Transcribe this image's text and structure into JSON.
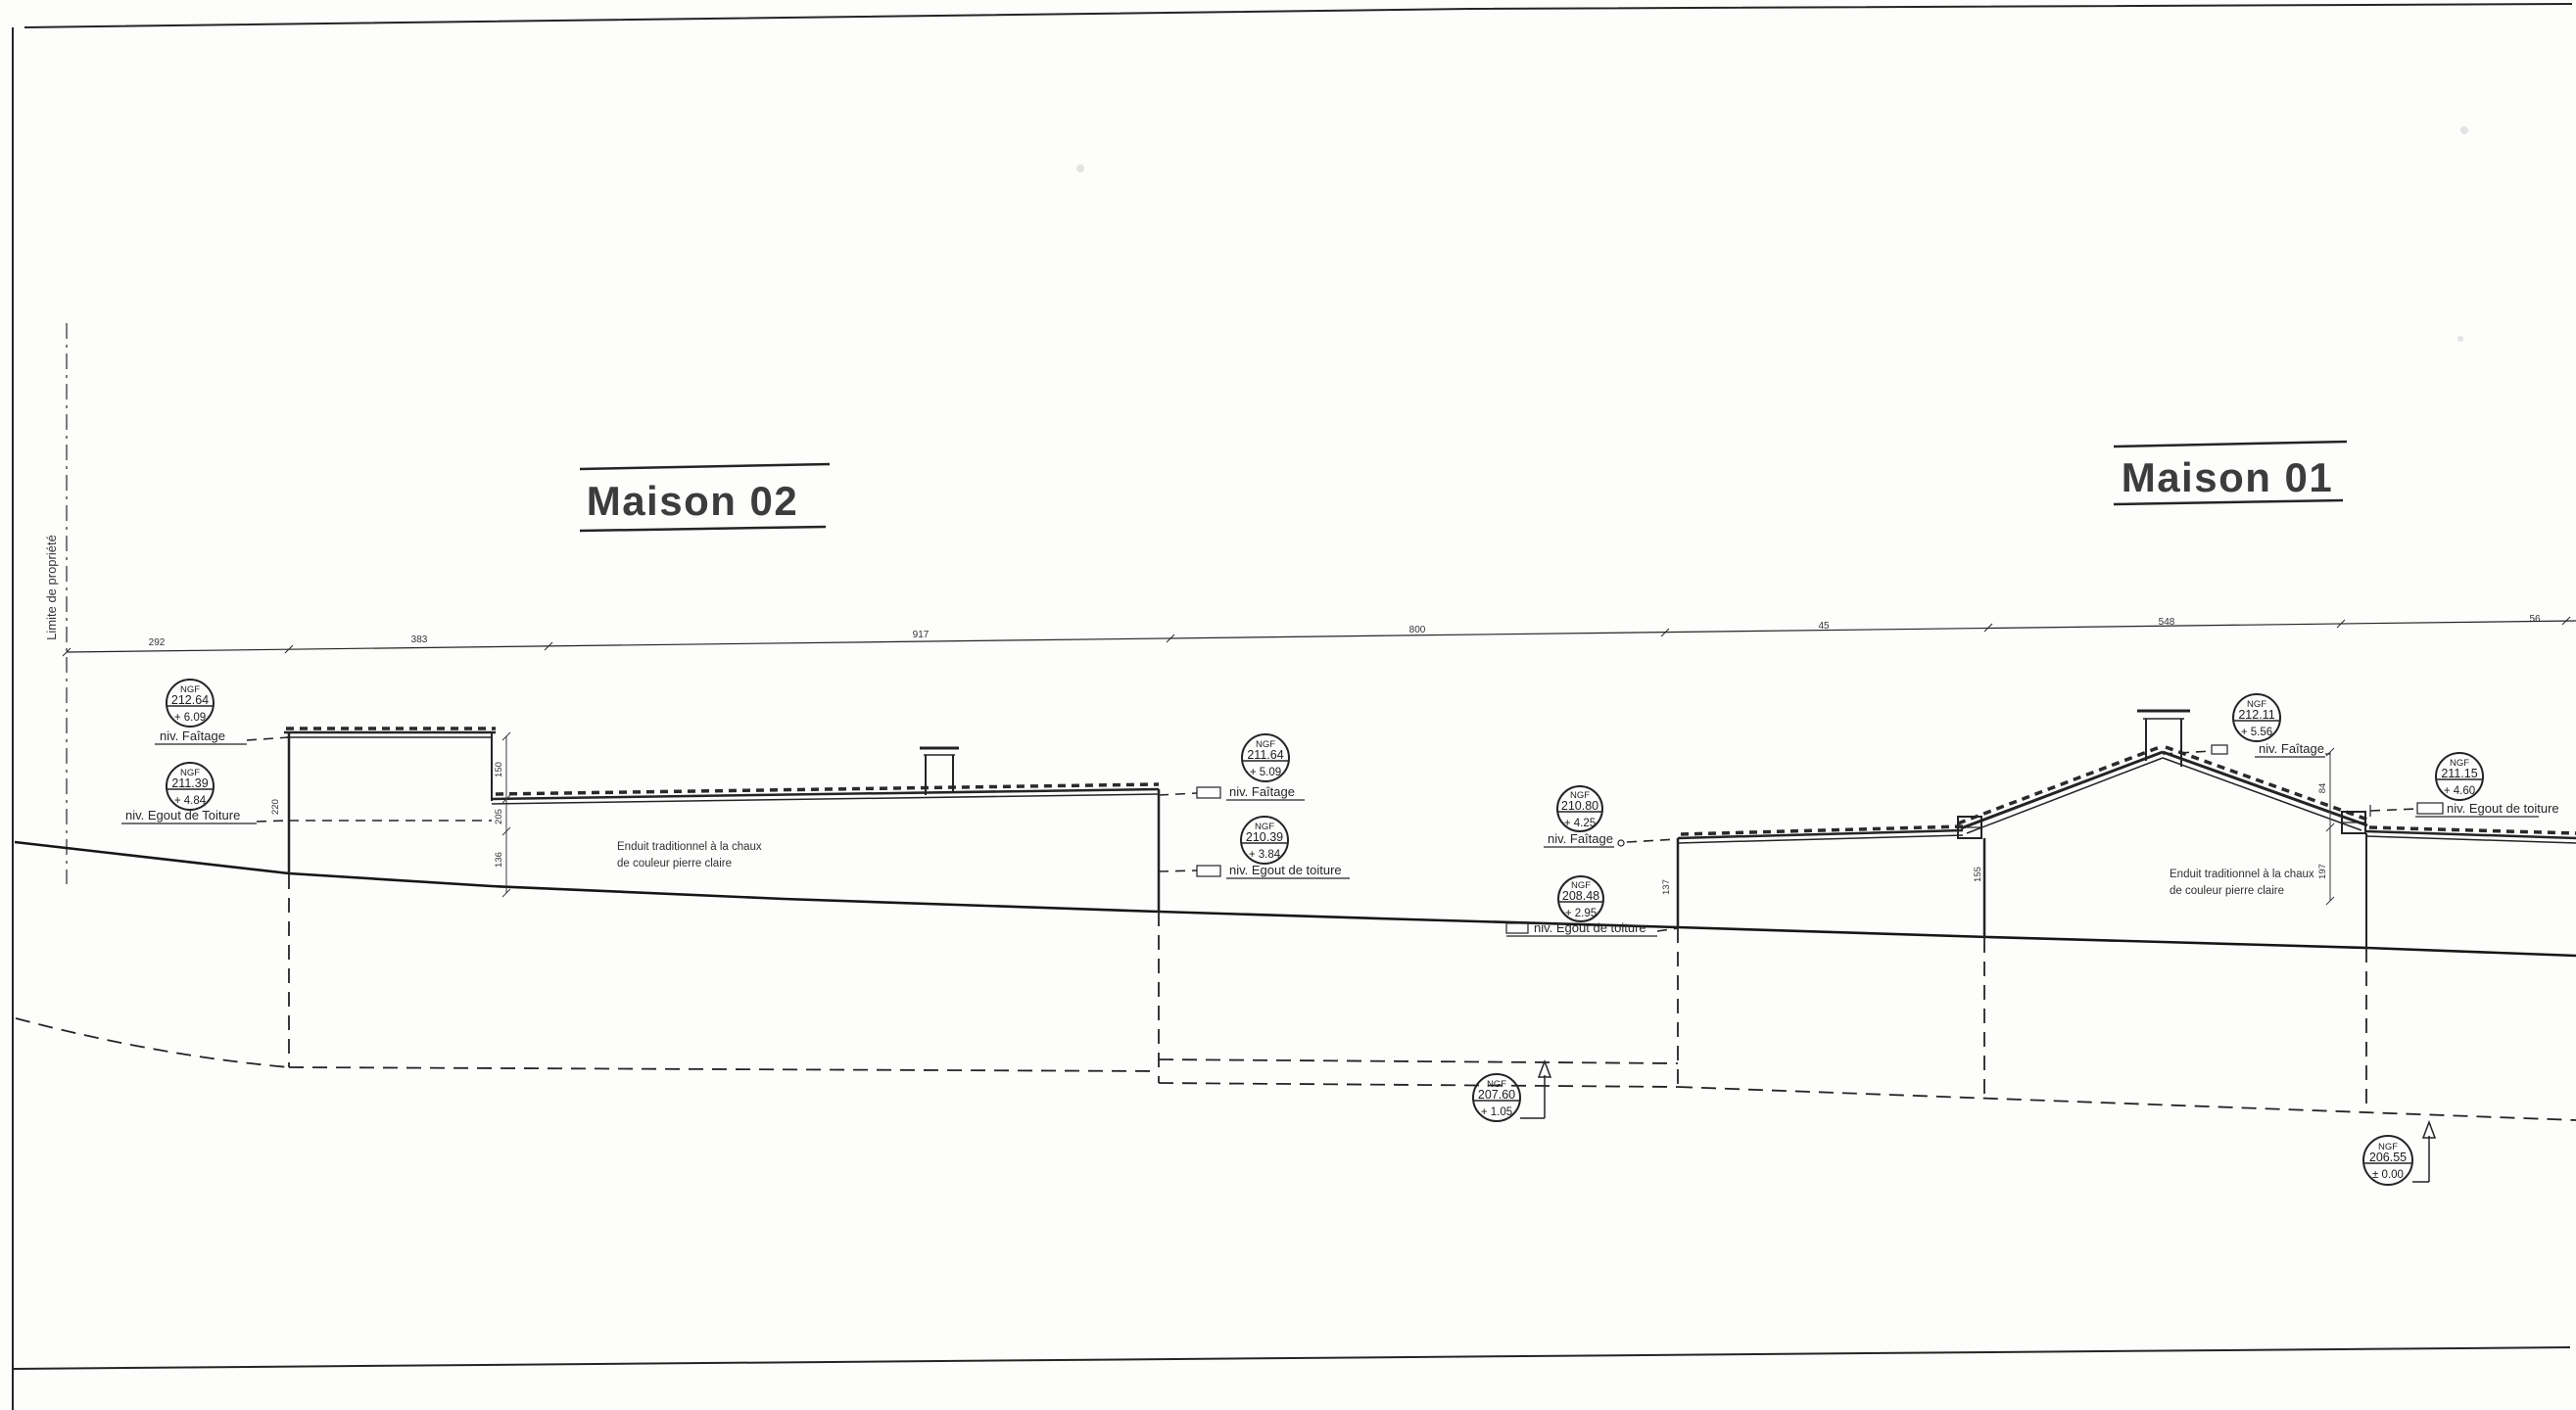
{
  "titles": {
    "maison02": "Maison 02",
    "maison01": "Maison 01"
  },
  "property_line": {
    "label": "Limite de propriété"
  },
  "top_dimensions": [
    "292",
    "383",
    "917",
    "800",
    "45",
    "548",
    "56"
  ],
  "vertical_dimensions": {
    "m02_wall": "220",
    "m02_roof_top": "150",
    "m02_roof_mid": "205",
    "m02_roof_low": "136",
    "link_wall": "137",
    "m01_left_wall": "155",
    "m01_roof": "84",
    "m01_right_wall": "197"
  },
  "level_markers": [
    {
      "unit": "NGF",
      "ngf": "212.64",
      "rel": "+ 6.09",
      "label": "niv. Faîtage"
    },
    {
      "unit": "NGF",
      "ngf": "211.39",
      "rel": "+ 4.84",
      "label": "niv. Egout de Toiture"
    },
    {
      "unit": "NGF",
      "ngf": "211.64",
      "rel": "+ 5.09",
      "label": "niv. Faîtage"
    },
    {
      "unit": "NGF",
      "ngf": "210.39",
      "rel": "+ 3.84",
      "label": "niv. Egout de toiture"
    },
    {
      "unit": "NGF",
      "ngf": "210.80",
      "rel": "+ 4.25",
      "label": "niv. Faîtage"
    },
    {
      "unit": "NGF",
      "ngf": "208.48",
      "rel": "+ 2.95",
      "label": "niv. Egout de toiture"
    },
    {
      "unit": "NGF",
      "ngf": "212.11",
      "rel": "+ 5.56",
      "label": "niv. Faîtage"
    },
    {
      "unit": "NGF",
      "ngf": "211.15",
      "rel": "+ 4.60",
      "label": "niv. Egout de toiture"
    },
    {
      "unit": "NGF",
      "ngf": "207.60",
      "rel": "+ 1.05",
      "label": ""
    },
    {
      "unit": "NGF",
      "ngf": "206.55",
      "rel": "± 0.00",
      "label": ""
    }
  ],
  "facade_notes": {
    "maison02_line1": "Enduit traditionnel à la chaux",
    "maison02_line2": "de couleur pierre claire",
    "maison01_line1": "Enduit traditionnel à la chaux",
    "maison01_line2": "de couleur pierre claire"
  }
}
